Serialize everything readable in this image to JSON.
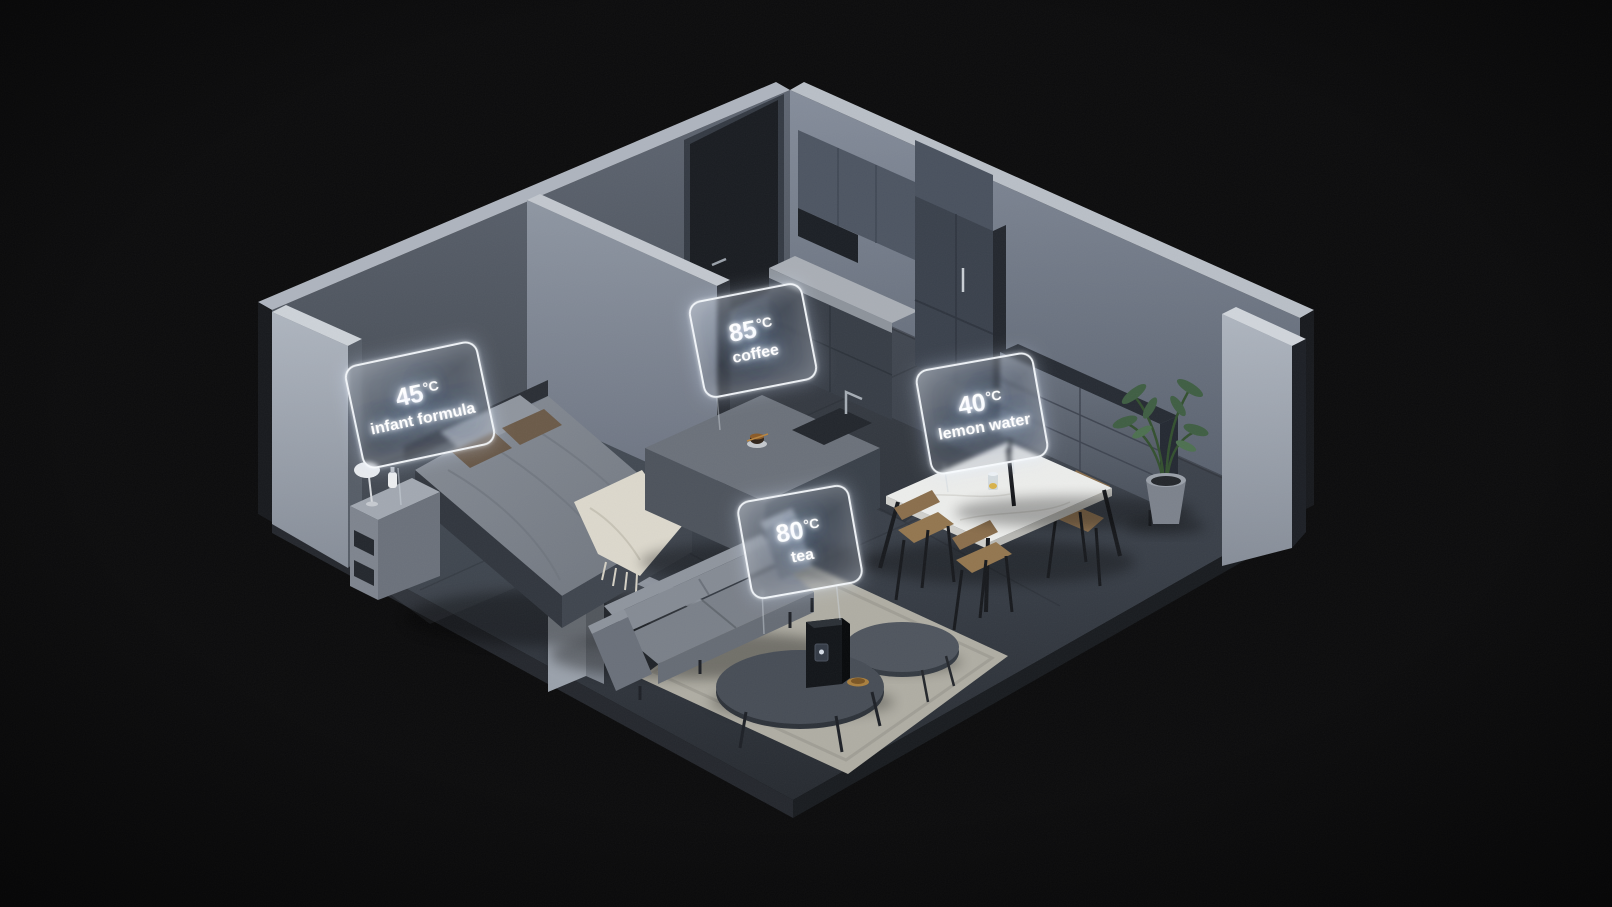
{
  "colors": {
    "background": "#0b0b0c",
    "label_border_glow": "#f5faff",
    "label_text_glow": "#cfe4ff",
    "floor": "#3c424b",
    "walls": "#6b7380",
    "rug": "#b4b2a8",
    "wood": "#8a6e4b",
    "plant": "#3f5e43"
  },
  "labels": {
    "infant_formula": {
      "value": "45",
      "unit": "°C",
      "beverage": "infant formula"
    },
    "coffee": {
      "value": "85",
      "unit": "°C",
      "beverage": "coffee"
    },
    "lemon_water": {
      "value": "40",
      "unit": "°C",
      "beverage": "lemon water"
    },
    "tea": {
      "value": "80",
      "unit": "°C",
      "beverage": "tea"
    }
  }
}
